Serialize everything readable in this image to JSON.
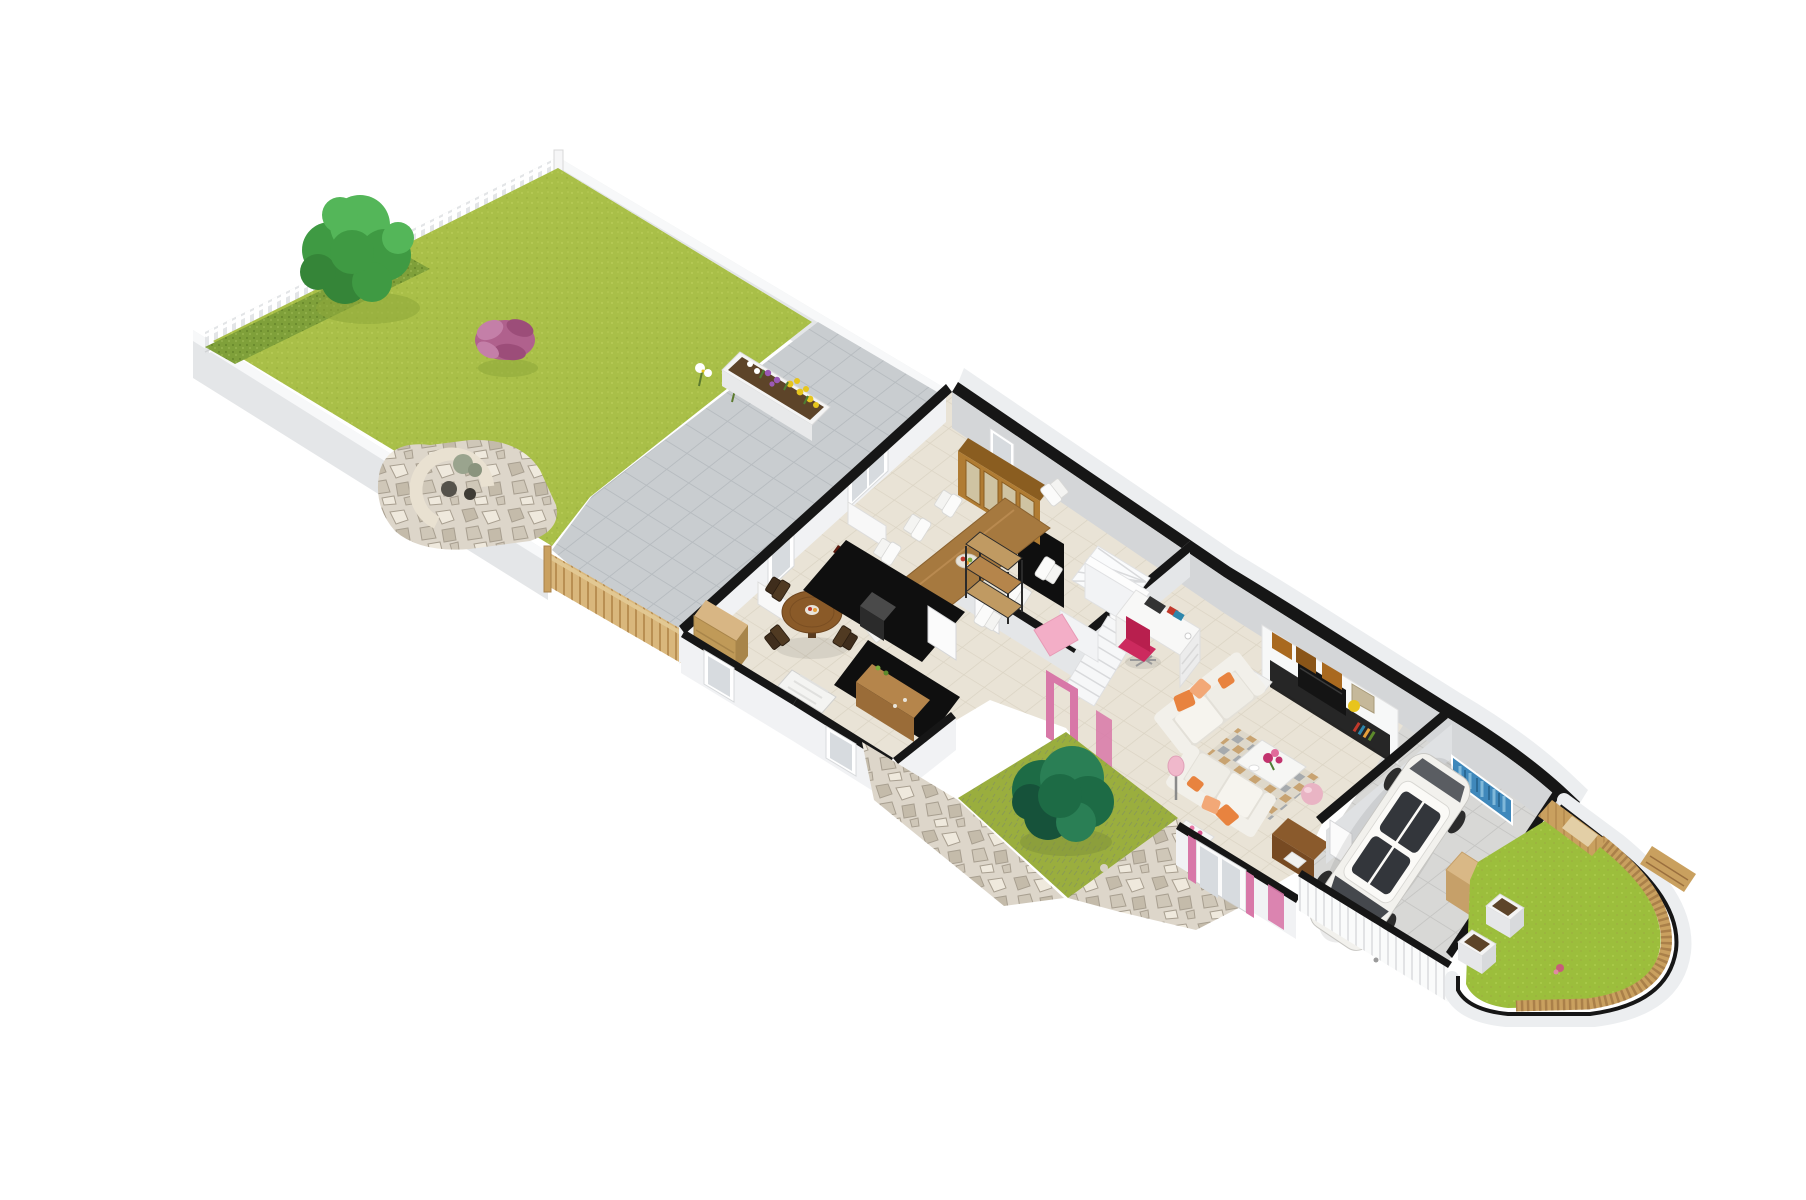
{
  "scene": {
    "type": "isometric-3d-floor-plan",
    "areas": [
      "back-garden",
      "patio",
      "fire-pit",
      "breakfast-nook",
      "kitchen",
      "dining-room",
      "hallway",
      "staircase",
      "office-nook",
      "living-room",
      "entry-courtyard",
      "garage",
      "front-garden"
    ],
    "objects": [
      "tree",
      "hedge",
      "picket-fence",
      "flower-planter",
      "stone-bench",
      "wooden-gate",
      "oak-hutch",
      "dining-table",
      "white-chairs",
      "round-table",
      "dark-chairs",
      "dresser",
      "kitchen-counters",
      "sideboard",
      "stairs",
      "winder-stairs",
      "desk",
      "pink-office-chair",
      "sofa",
      "orange-pillows",
      "tv-wall-unit",
      "yellow-lamp",
      "checkered-rug",
      "flower-table",
      "pink-ball",
      "console-table",
      "courtyard-tree",
      "entrance-door",
      "pink-door-frames",
      "white-car",
      "blue-wall-art",
      "workbench",
      "wooden-fence",
      "planter-boxes",
      "garden-bench"
    ]
  },
  "colors": {
    "background": "#ffffff",
    "lawn": "#a9bf48",
    "lawnDot": "#b8cb57",
    "lawnDot2": "#9cb23e",
    "lawnShadow": "#8ea83a",
    "hedge": "#7fa03a",
    "hedgeDark": "#6a8a2c",
    "hedgeLight": "#91b04a",
    "courtLawn": "#9aae3e",
    "courtDry": "#8a9a55",
    "rightLawn": "#9cbe3c",
    "rightLawnDot": "#aacb4a",
    "patio": "#c9cdd0",
    "patioLine": "#b7bcc0",
    "stone": "#ddd6ca",
    "stoneDark": "#c4bbaa",
    "stoneLight": "#efe9dd",
    "stoneLine": "#a89f90",
    "tile": "#e9e3d6",
    "tileLine": "#dbd4c4",
    "garageFloor": "#d8d8d6",
    "garageLine": "#c6c6c4",
    "wallTop": "#161616",
    "wallFaceLight": "#f1f2f4",
    "wallFaceShade": "#d4d6d8",
    "wallFaceMid": "#e4e6e8",
    "fenceWhite": "#e3e5e7",
    "picket": "#ffffff",
    "gateWood": "#d9b77c",
    "gateSlat": "#b98f52",
    "woodFence": "#c9a05f",
    "woodFenceDark": "#9a6f3e",
    "oak": "#b07c33",
    "oakDark": "#8a5d20",
    "glassPane": "#d7dbdf",
    "tableWood": "#a6793f",
    "tableWoodDark": "#8a6230",
    "chairWhite": "#f4f4f2",
    "chairDark": "#3f2d1c",
    "dresser": "#c09a58",
    "dresserTop": "#d8b684",
    "kitchenBlack": "#0f0f0f",
    "maroon": "#5c1a0e",
    "sideboard": "#b5854b",
    "sideboardDark": "#9a6c38",
    "sofa": "#f2f0ea",
    "sofaShade": "#e3e0d8",
    "orange": "#e8833f",
    "orangeLight": "#f2a877",
    "rugBase": "#ded8ca",
    "rugTan": "#c49a62",
    "rugGray": "#8f97a2",
    "unitWhite": "#f7f8f8",
    "tvBlack": "#141414",
    "boxWood": "#a9691f",
    "lampYellow": "#e8c41c",
    "pink": "#d878a8",
    "pinkChair": "#cc2a5e",
    "pinkBall": "#e9b4c4",
    "pinkBed": "#f3aec7",
    "treeGreen": "#3f9a43",
    "treeGreenDark": "#358538",
    "treeGreenLight": "#54b659",
    "courtTree": "#1d6b45",
    "courtTreeDark": "#16523a",
    "courtTreeLight": "#2a7f55",
    "blueArt": "#3f88bb",
    "blueArtLight": "#7fb8d9",
    "blueArtDark": "#2a6a96",
    "carBody": "#f2f1ed",
    "carGlass": "#45484d",
    "carDark": "#2c2c2c",
    "purplePlant": "#b0618d",
    "purplePlantDark": "#9c4d79",
    "purplePlantLight": "#c47fa8",
    "flowerYellow": "#e7c51d",
    "flowerPurple": "#9b59b6",
    "flowerWhite": "#ffffff",
    "flowerMagenta": "#c2336e",
    "planterSoil": "#5d4429",
    "benchStone": "#e9e1d1",
    "deskWhite": "#f8f8f7"
  }
}
